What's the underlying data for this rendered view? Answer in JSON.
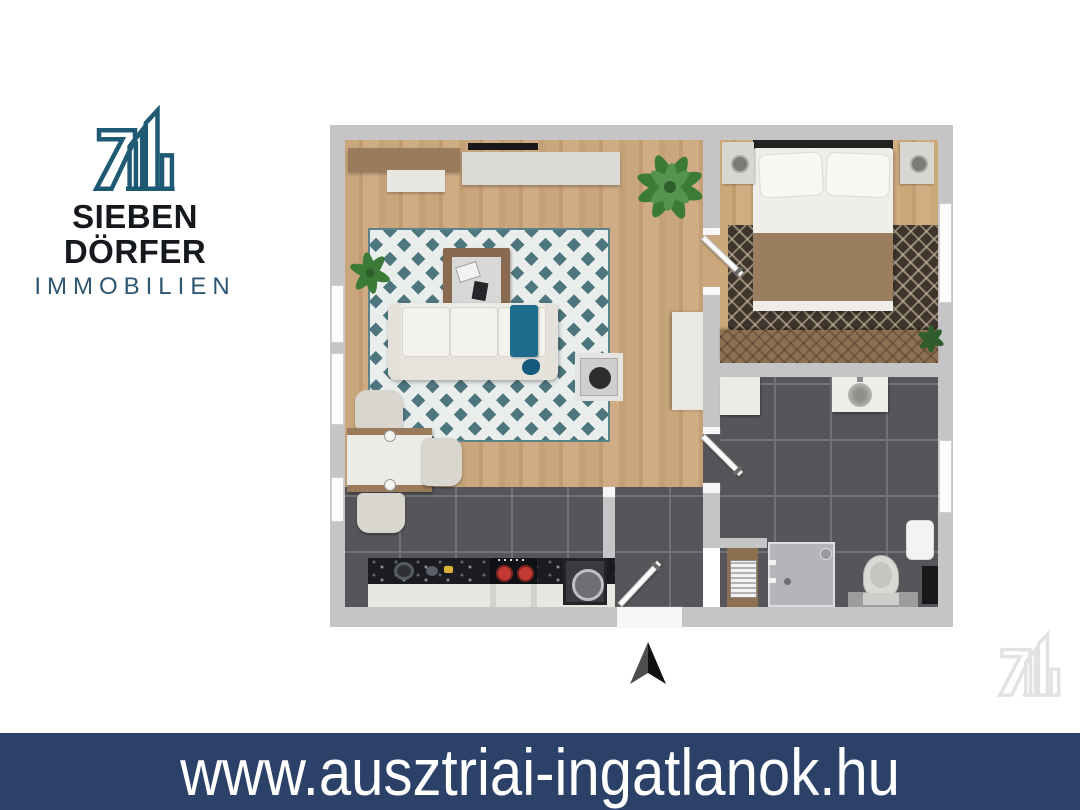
{
  "branding": {
    "company_name": "SIEBEN DÖRFER",
    "company_subtitle": "IMMOBILIEN",
    "logo_icon": "seven-buildings-logo-icon",
    "mark_color": "#1f5a74",
    "name_color": "#15181c",
    "subtitle_color": "#2e5670"
  },
  "banner": {
    "text": "www.ausztriai-ingatlanok.hu",
    "background_color": "#2b4168",
    "text_color": "#ffffff"
  },
  "floorplan": {
    "wall_color": "#c5c5c7",
    "wood_floor_color": "#c7a47a",
    "dark_tile_color": "#565559",
    "living_rug_teal": "#4e767e",
    "sofa_color": "#edebe5",
    "accent_throw_teal": "#1f6b8d",
    "bedroom_blanket_color": "#9b7d60",
    "bedroom_rug_color": "#3e362d",
    "kitchen_counter_color": "#1b1c21",
    "stove_burner_red": "#c23a33",
    "window_color": "#fdfdfd"
  },
  "compass": {
    "icon": "north-arrow-icon",
    "dark_color": "#101010",
    "light_color": "#4e4e4e"
  },
  "watermark": {
    "icon": "logo-watermark-icon",
    "color": "#e0e2e4"
  }
}
